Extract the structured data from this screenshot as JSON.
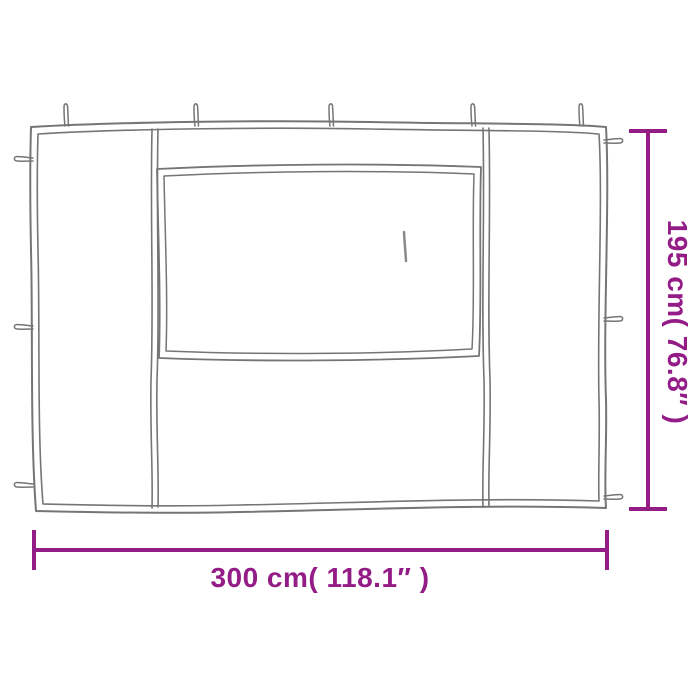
{
  "diagram": {
    "type": "product-dimension-diagram",
    "subject": "gazebo-sidewall-with-window",
    "width_label": "300 cm( 118.1″ )",
    "height_label": "195 cm( 76.8″ )"
  },
  "colors": {
    "dimension": "#941c87",
    "outline": "#757575",
    "zipper": "#8a8a8a",
    "background": "#ffffff"
  }
}
